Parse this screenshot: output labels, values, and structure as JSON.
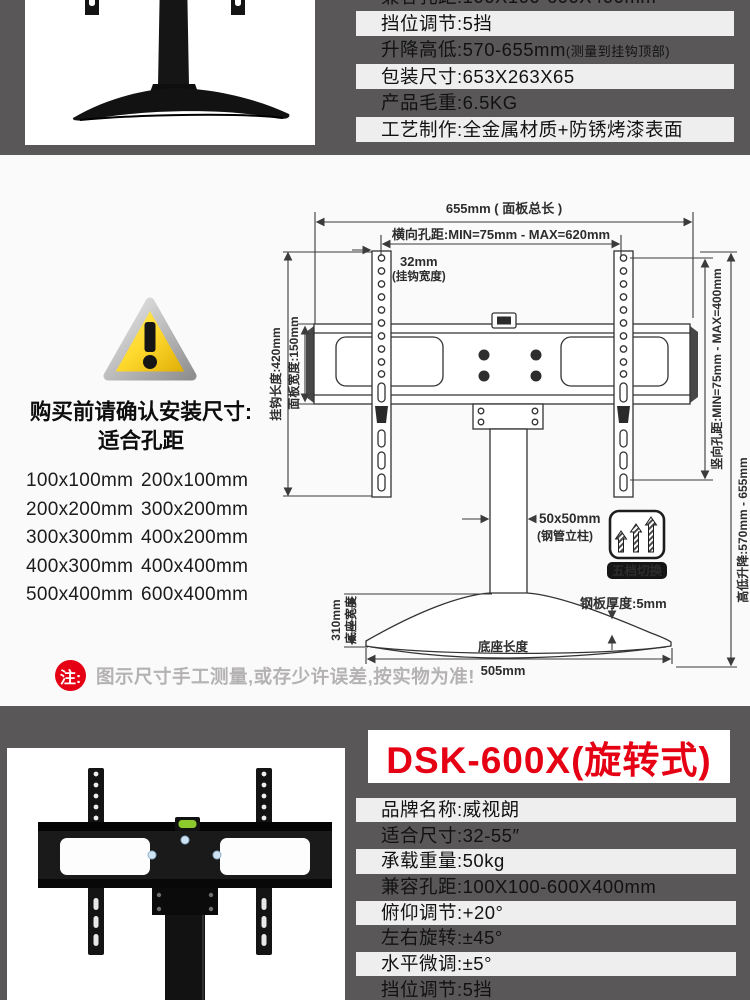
{
  "colors": {
    "section_dark_gray": "#595757",
    "spec_row_white": "#efeeee",
    "accent_red": "#e60014",
    "note_gray_text": "#b4b2b2",
    "warning_yellow": "#ffd92e",
    "level_green": "#8bc92c"
  },
  "top": {
    "specs": [
      {
        "text": "兼容孔距:100X100-600X400mm",
        "suffix": ""
      },
      {
        "text": "挡位调节:5挡",
        "suffix": ""
      },
      {
        "text": "升降高低:570-655mm",
        "suffix": "(测量到挂钩顶部)"
      },
      {
        "text": "包装尺寸:653X263X65",
        "suffix": ""
      },
      {
        "text": "产品毛重:6.5KG",
        "suffix": ""
      },
      {
        "text": "工艺制作:全金属材质+防锈烤漆表面",
        "suffix": ""
      }
    ]
  },
  "middle": {
    "headline_line1": "购买前请确认安装尺寸:",
    "headline_line2": "适合孔距",
    "hole_sizes": [
      "100x100mm",
      "200x100mm",
      "200x200mm",
      "300x200mm",
      "300x300mm",
      "400x200mm",
      "400x300mm",
      "400x400mm",
      "500x400mm",
      "600x400mm"
    ],
    "note_badge": "注:",
    "note_text": "图示尺寸手工测量,或存少许误差,按实物为准!",
    "diagram": {
      "total_length": "655mm ( 面板总长 )",
      "horizontal_pitch": "横向孔距:MIN=75mm - MAX=620mm",
      "hook_width_value": "32mm",
      "hook_width_label": "(挂钩宽度)",
      "hook_length": "挂钩长度:420mm",
      "panel_width": "面板宽度:150mm",
      "vertical_pitch": "竖向孔距:MIN=75mm - MAX=400mm",
      "lift_range": "高低升降:570mm - 655mm",
      "column_size": "50x50mm",
      "column_label": "(钢管立柱)",
      "plate_thickness": "钢板厚度:5mm",
      "base_length_label": "底座长度",
      "base_length_value": "505mm",
      "base_width_value": "310mm",
      "base_width_label": "底座宽度",
      "gear_badge": "五档切换"
    }
  },
  "bottom": {
    "title": "DSK-600X(旋转式)",
    "specs": [
      {
        "text": "品牌名称:威视朗"
      },
      {
        "text": "适合尺寸:32-55″"
      },
      {
        "text": "承载重量:50kg"
      },
      {
        "text": "兼容孔距:100X100-600X400mm"
      },
      {
        "text": "俯仰调节:+20°"
      },
      {
        "text": "左右旋转:±45°"
      },
      {
        "text": "水平微调:±5°"
      },
      {
        "text": "挡位调节:5挡"
      }
    ]
  }
}
